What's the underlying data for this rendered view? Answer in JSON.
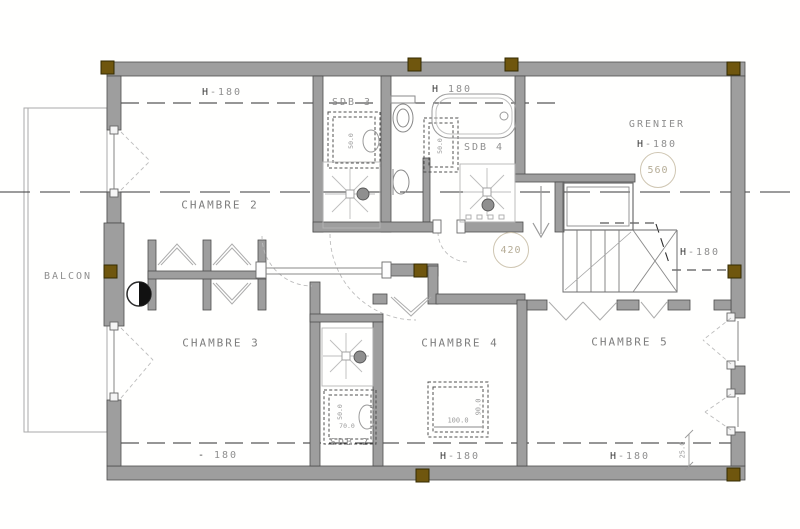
{
  "colors": {
    "wall_fill": "#9e9e9e",
    "wall_edge": "#4d4d4d",
    "column_fill": "#6f560e",
    "column_edge": "#332a00",
    "dash_line": "#2e2e2e",
    "fixture_line": "#9a9a9a",
    "faint_line": "#bdbdbd",
    "label_text": "#8f8f8f",
    "badge_ring": "#cfc6b2"
  },
  "rooms": {
    "chambre2": "CHAMBRE 2",
    "chambre3": "CHAMBRE 3",
    "chambre4": "CHAMBRE 4",
    "chambre5": "CHAMBRE 5",
    "sdb2": "SDB 2",
    "sdb3": "SDB 3",
    "sdb4": "SDB 4",
    "grenier": "GRENIER",
    "balcon": "BALCON"
  },
  "heights": {
    "top_left": "H-180",
    "top_center": "H 180",
    "grenier": "H-180",
    "stair_right": "H-180",
    "bottom_left": "- 180",
    "bottom_center": "H-180",
    "bottom_right": "H-180"
  },
  "badges": {
    "grenier": "560",
    "hall": "420"
  },
  "dims": {
    "skylight_w": "100.0",
    "skylight_h": "90.0",
    "right_offset": "25.0",
    "sdb3_vanity": "50.0",
    "sdb4_vanity": "50.0",
    "sdb2_vanity_w": "70.0",
    "sdb2_vanity_d": "50.0"
  }
}
